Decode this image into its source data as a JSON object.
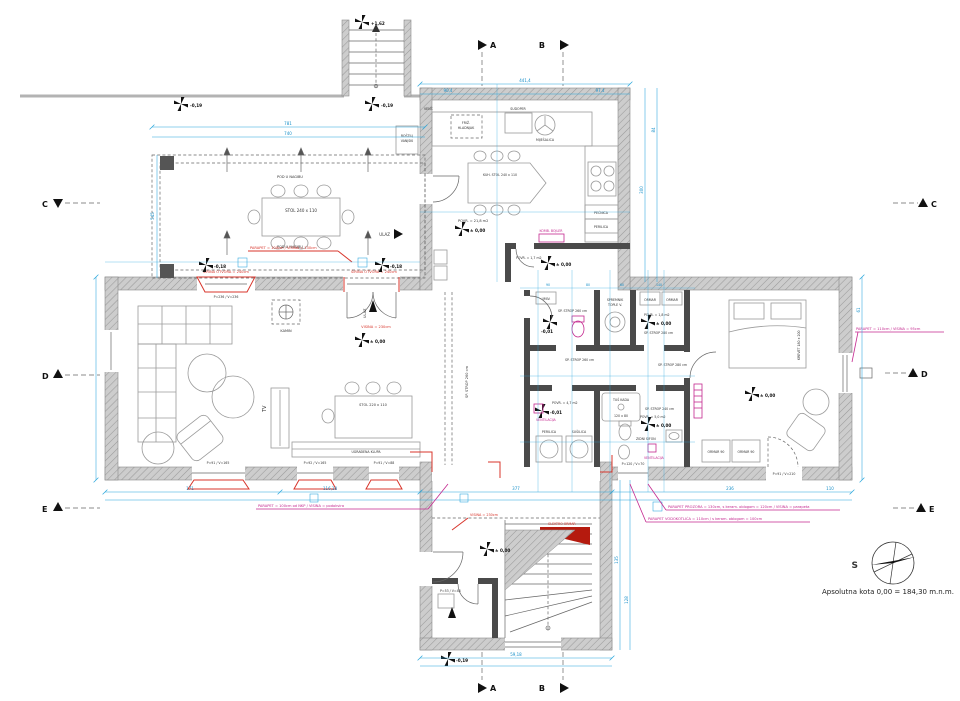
{
  "drawing": {
    "compass": "S",
    "datum": "Apsolutna kota 0,00 = 184,30 m.n.m."
  },
  "sections": {
    "a": "A",
    "b": "B",
    "c": "C",
    "d": "D",
    "e": "E"
  },
  "levels": {
    "p162": "+1,62",
    "m019": "-0,19",
    "zero": "± 0,00",
    "m018": "-0,18",
    "m001": "-0,01"
  },
  "terrace": {
    "table": "STOL 240 x 110",
    "slope": "POD U NAGIBU",
    "grill1": "ROŠTILJ",
    "grill2": "VANJSKI",
    "entrance": "ULAZ",
    "parapet": "PARAPET = 100cm / VISINA = 130cm"
  },
  "kitchen": {
    "fridge1": "FRIŽ.",
    "fridge2": "HLADNJAK",
    "sink": "SUDOPER",
    "mixer": "MIJEŠALICA",
    "oven": "PEĆNICA",
    "dw": "PERILICA",
    "table": "KUH. STOL 240 x 110",
    "area": "POVR. = 21,8 m2",
    "vent": "VENT.",
    "boiler": "KOMB. BOJLER",
    "wc_area": "POVR. = 1,7 m2"
  },
  "living": {
    "tv": "TV",
    "table": "STOL 220 x 110",
    "bench": "UGRAĐENA KLUPA",
    "fireplace": "KAMIN",
    "door_height": "VISINA = 230cm",
    "opening": "ŠIRINA OTVORA = 240cm",
    "win_big": "P=236 / V=236",
    "win1": "P=91 / V=165",
    "win2": "P=92 / V=165",
    "win3": "P=91 / V=88",
    "entrance": "ULAZ"
  },
  "hall": {
    "ceiling": "SP. STROP 260 cm"
  },
  "bath": {
    "ceiling260": "SP. STROP 260 cm",
    "ceiling240": "SP. STROP 240 cm",
    "ceiling280": "SP. STROP 280 cm",
    "tank1": "SPREMNIK",
    "tank2": "TOPLE V.",
    "basin": "UMIV.",
    "gard_area": "POVR. = 1,8 m2",
    "wardrobe": "ORMAR",
    "laundry_area": "POVR. = 4,7 m2",
    "washer": "PERILICA",
    "dryer": "SUŠILICA",
    "vent": "VENTILACIJA",
    "shower1": "TUŠ KADA",
    "shower2": "120 x 80",
    "siphon": "ZIDNI SIFON",
    "bath_area": "POVR. = 5,0 m2",
    "window": "P=120 / V=70"
  },
  "bedroom": {
    "bed": "KREVET 180 x 200",
    "wardrobe": "ORMAR 90",
    "door": "P=91 / V=210",
    "parapet": "PARAPET = 110cm / VISINA = 95cm"
  },
  "entry": {
    "electro": "ELEKTRO ORMAR",
    "height": "VISINA = 230cm",
    "small_window": "P=53 / V=48"
  },
  "notes": {
    "parapet_left": "PARAPET = 100cm od NKP / VISINA = podokvira",
    "parapet_r1": "PARAPET PROZORA = 130cm, s keram. oblogom = 120cm / VISINA = parapeta",
    "parapet_r2": "PARAPET VODOKOTLIĆA = 110cm / s keram. oblogom = 100cm"
  },
  "dims": {
    "top_total": "441,4",
    "top_left": "90,4",
    "top_right": "97,4",
    "terrace_a": "781",
    "terrace_b": "740",
    "terrace_h": "545",
    "bottom_1": "171",
    "bottom_2": "116,18",
    "bottom_3": "377",
    "bottom_4": "236",
    "bottom_5": "110",
    "kitchen_h": "300",
    "kitchen_s": "84",
    "wing_w": "59,18",
    "wing_h1": "135",
    "wing_h2": "128",
    "right_h": "61",
    "c1": "90",
    "c2": "80",
    "c3": "60",
    "c4": "140"
  }
}
